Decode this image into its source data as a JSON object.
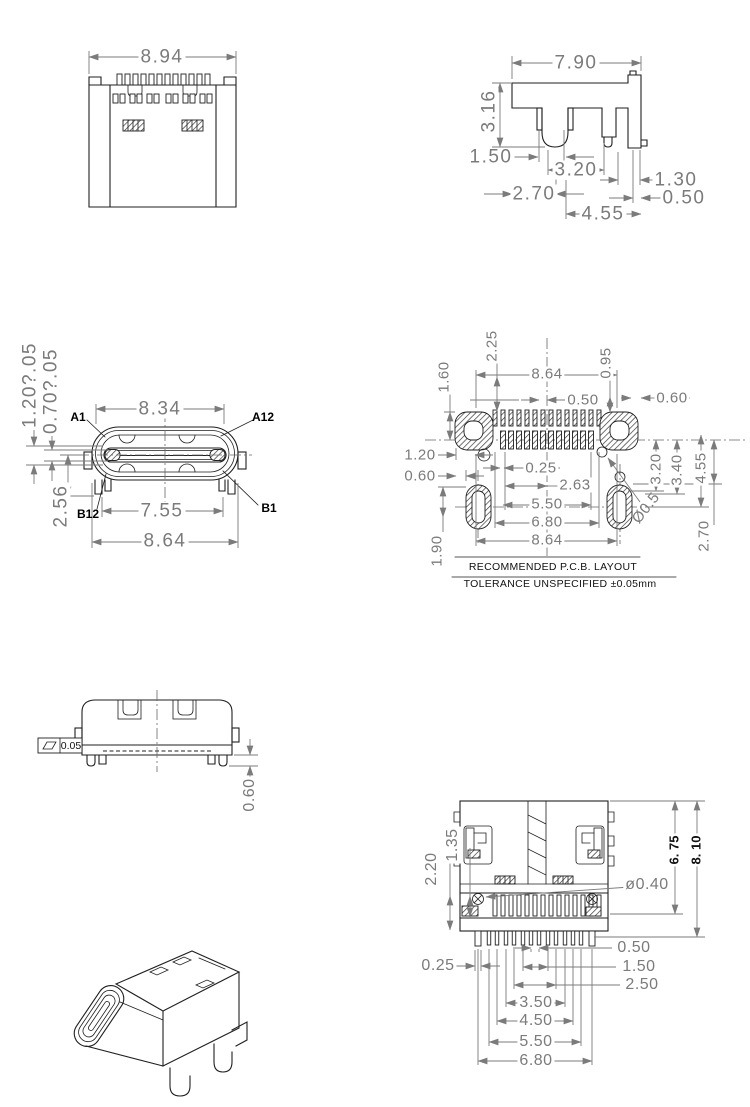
{
  "views": {
    "top": {
      "dim_width": "8.94"
    },
    "side": {
      "dim_width": "7.90",
      "dim_height": "3.16",
      "dim_1_50": "1.50",
      "dim_3_20": "3.20",
      "dim_1_30": "1.30",
      "dim_2_70": "2.70",
      "dim_0_50": "0.50",
      "dim_4_55": "4.55"
    },
    "front": {
      "dim_8_34": "8.34",
      "dim_7_55": "7.55",
      "dim_8_64": "8.64",
      "dim_2_56": "2.56",
      "dim_1_20_tol": "1.20?.05",
      "dim_0_70_tol": "0.70?.05",
      "pin_a1": "A1",
      "pin_a12": "A12",
      "pin_b1": "B1",
      "pin_b12": "B12"
    },
    "pcb": {
      "dim_1_60": "1.60",
      "dim_2_25": "2.25",
      "dim_8_64_top": "8.64",
      "dim_0_50": "0.50",
      "dim_0_95": "0.95",
      "dim_0_60_right": "0.60",
      "dim_1_20": "1.20",
      "dim_0_60_left": "0.60",
      "dim_0_25": "0.25",
      "dim_2_63": "2.63",
      "dim_5_50": "5.50",
      "dim_6_80": "6.80",
      "dim_8_64_bottom": "8.64",
      "dim_1_90": "1.90",
      "dim_3_20": "3.20",
      "dim_3_40": "3.40",
      "dim_4_55": "4.55",
      "dim_2_70": "2.70",
      "dim_hole": "Ø0.5",
      "note_title": "RECOMMENDED   P.C.B.  LAYOUT",
      "note_tolerance": "TOLERANCE  UNSPECIFIED  ±0.05mm"
    },
    "rear": {
      "flatness": "0.05",
      "dim_0_60": "0.60"
    },
    "bottom": {
      "dim_2_20": "2.20",
      "dim_1_35": "1.35",
      "dim_6_75": "6. 75",
      "dim_8_10": "8. 10",
      "dim_hole": "ø0.40",
      "dim_0_25": "0.25",
      "dim_0_50": "0.50",
      "dim_1_50": "1.50",
      "dim_2_50": "2.50",
      "dim_3_50": "3.50",
      "dim_4_50": "4.50",
      "dim_5_50": "5.50",
      "dim_6_80": "6.80"
    }
  }
}
